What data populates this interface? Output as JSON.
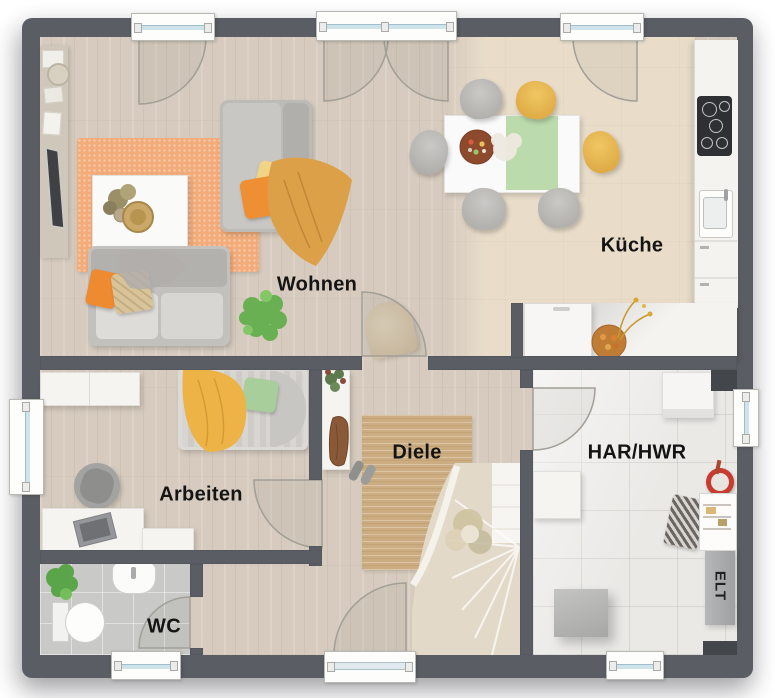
{
  "image_type": "floor-plan",
  "rooms": {
    "wohnen": {
      "label": "Wohnen"
    },
    "kueche": {
      "label": "Küche"
    },
    "arbeiten": {
      "label": "Arbeiten"
    },
    "diele": {
      "label": "Diele"
    },
    "wc": {
      "label": "WC"
    },
    "har_hwr": {
      "label": "HAR/HWR"
    },
    "elt": {
      "label": "ELT"
    }
  },
  "palette": {
    "wall": "#5a5e64",
    "wood_floor": "#d6cbbe",
    "kitchen_floor": "#e9ddca",
    "har_tile": "#eae9e6",
    "wc_tile": "#c9c9c7",
    "orange_rug": "#f2ab79",
    "jute_rug": "#ccad82",
    "mustard": "#dca048",
    "orange": "#ef8f33",
    "pale_yellow": "#f2d486",
    "green": "#a8cf9b",
    "stairs": "#e3d9c8",
    "window_glass": "#cfe3ea",
    "label_text": "#141414"
  }
}
